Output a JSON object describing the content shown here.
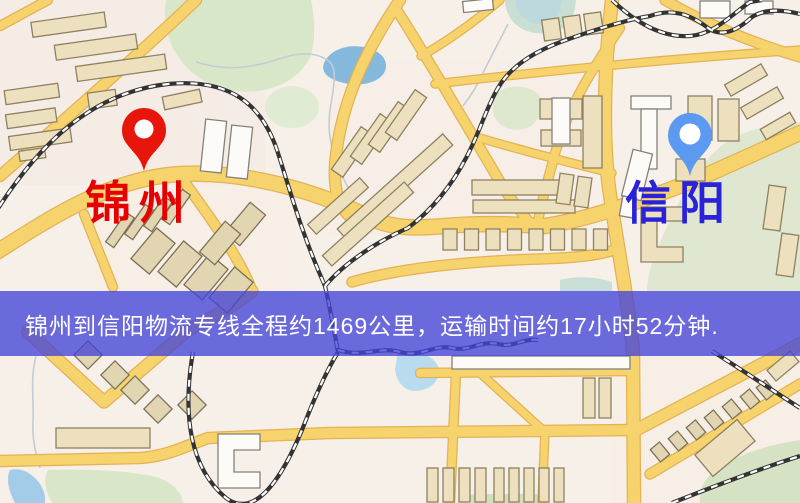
{
  "banner": {
    "text": "锦州到信阳物流专线全程约1469公里，运输时间约17小时52分钟.",
    "background_color": "rgba(68,68,216,0.78)",
    "text_color": "#ffffff"
  },
  "markers": {
    "origin": {
      "label": "锦州",
      "pin_color": "#e8150b",
      "label_color": "#e60000"
    },
    "destination": {
      "label": "信阳",
      "pin_color": "#5b9af0",
      "label_color": "#2a22d8"
    }
  },
  "route_summary": {
    "origin": "锦州",
    "destination": "信阳",
    "distance_text": "约1469公里",
    "duration_text": "约17小时52分钟"
  },
  "map_palette": {
    "background": "#f7f0e9",
    "road_fill": "#f7d36e",
    "road_casing": "#e3b254",
    "building_fill": "#ece0bf",
    "building_white": "#fcfbf7",
    "green_area": "#d9e7c9",
    "water": "#84b8dc",
    "railway": "#333333"
  }
}
